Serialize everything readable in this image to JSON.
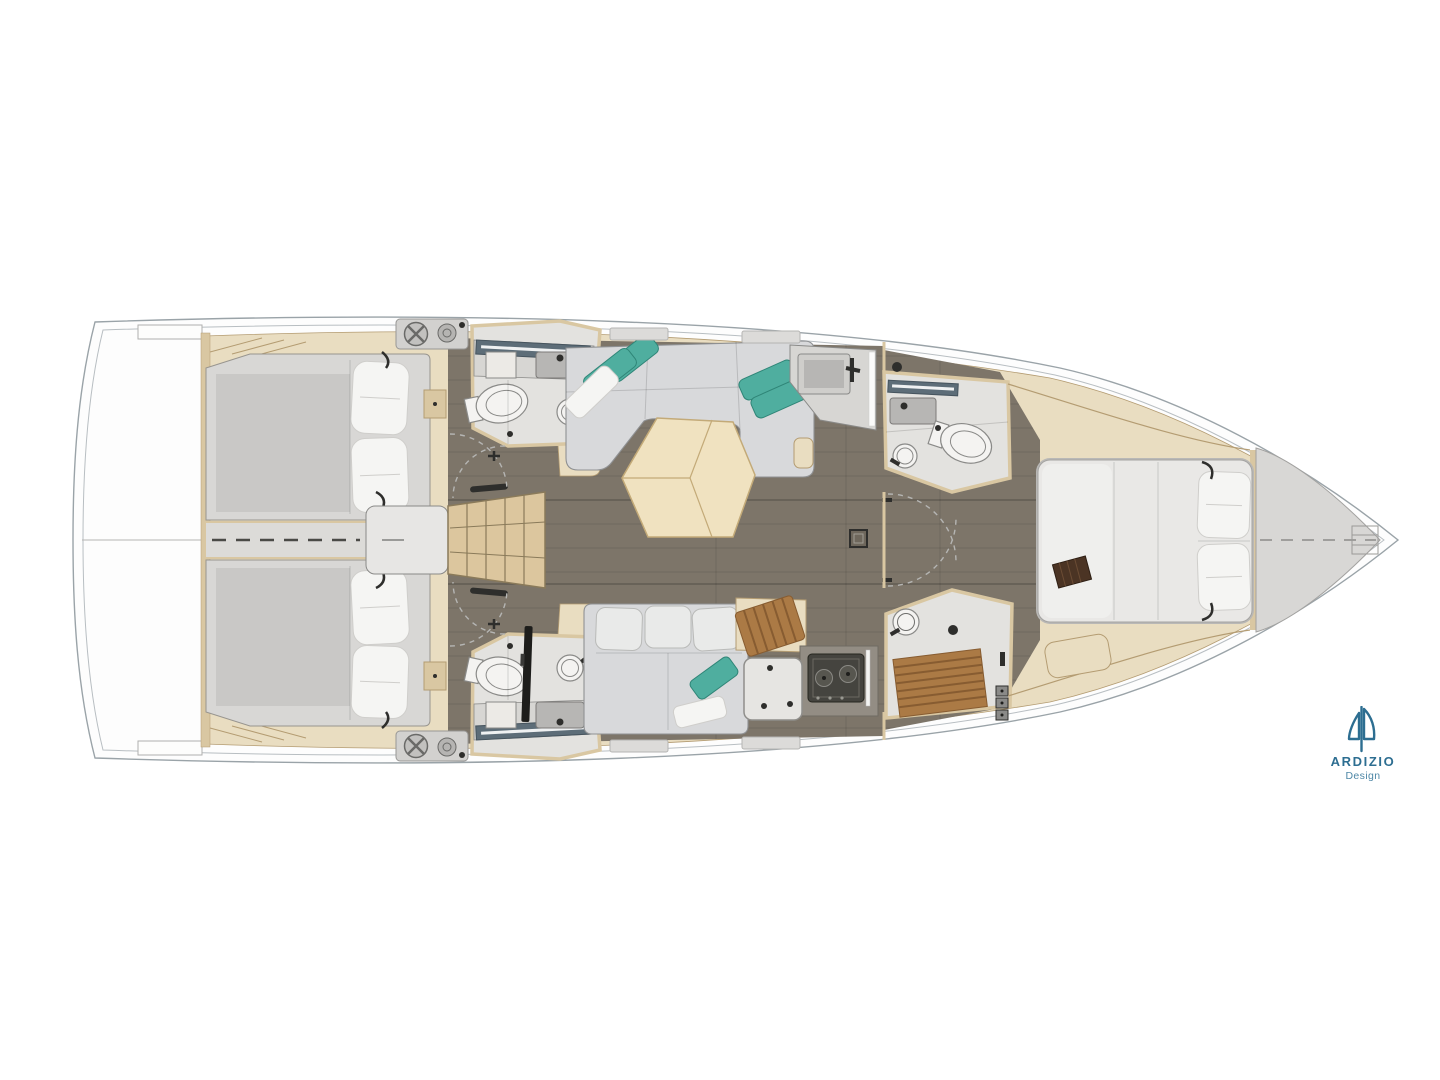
{
  "branding": {
    "name": "ARDIZIO",
    "tagline": "Design"
  },
  "colors": {
    "logoBlue": "#2d6e91",
    "logoBlueLight": "#4d87a6",
    "hullLine": "#9aa3a8",
    "hullInner": "#b8bec2",
    "deckBeige": "#e9ddc1",
    "deckBeigeDark": "#d9c7a2",
    "woodTrim": "#b49c72",
    "floorWood": "#7d7569",
    "corridorGray": "#dcdbd8",
    "mattress": "#c9c8c6",
    "mattressLight": "#d8d7d5",
    "pillow": "#f5f5f3",
    "pillowLine": "#cfcecb",
    "sofa": "#d8d9db",
    "sofaLine": "#8f9193",
    "cushion": "#e9eae9",
    "teal": "#4fae9f",
    "tealDark": "#2f8577",
    "tableWood": "#f0e2c0",
    "tableLine": "#c3aa78",
    "bathFloor": "#e3e2df",
    "fixture": "#f4f3f1",
    "fixtureLine": "#8a8a88",
    "counter": "#d7d6d3",
    "sinkGray": "#b7b6b4",
    "steelBlue": "#5d6d78",
    "dark": "#2e2e2c",
    "teak": "#ab7a45",
    "teakDark": "#875c31",
    "lockerGray": "#d8d7d5",
    "stairWood": "#dcc69e",
    "stove": "#45443f",
    "arcGray": "#b5b5b3"
  }
}
